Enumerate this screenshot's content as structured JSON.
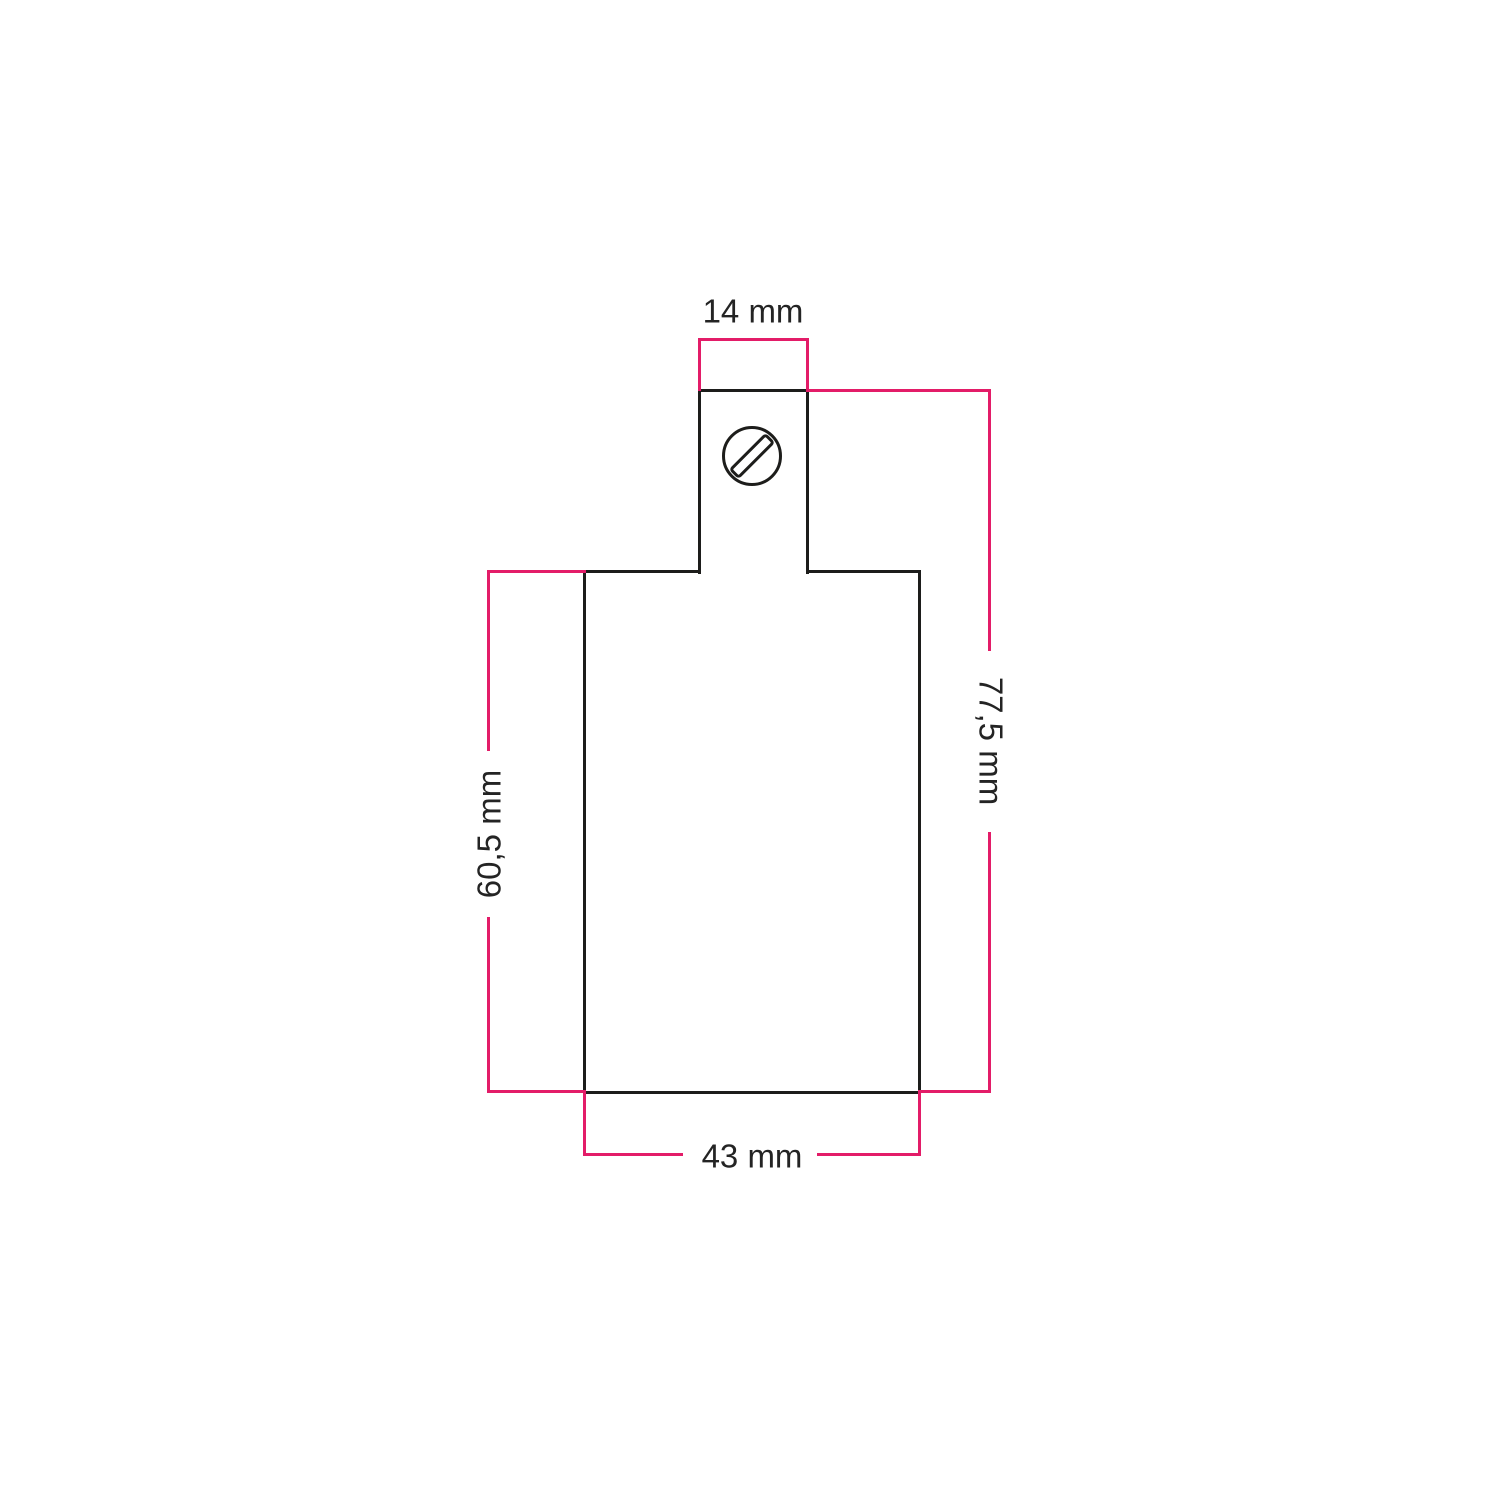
{
  "diagram": {
    "accent_color": "#e31c68",
    "outline_color": "#1d1d1b",
    "text_color": "#242424",
    "icon": "slotted-screw-icon",
    "dimensions": {
      "top_width": {
        "label": "14 mm",
        "value_mm": 14
      },
      "overall_height": {
        "label": "77,5 mm",
        "value_mm": 77.5
      },
      "body_height": {
        "label": "60,5 mm",
        "value_mm": 60.5
      },
      "body_width": {
        "label": "43 mm",
        "value_mm": 43
      }
    }
  }
}
